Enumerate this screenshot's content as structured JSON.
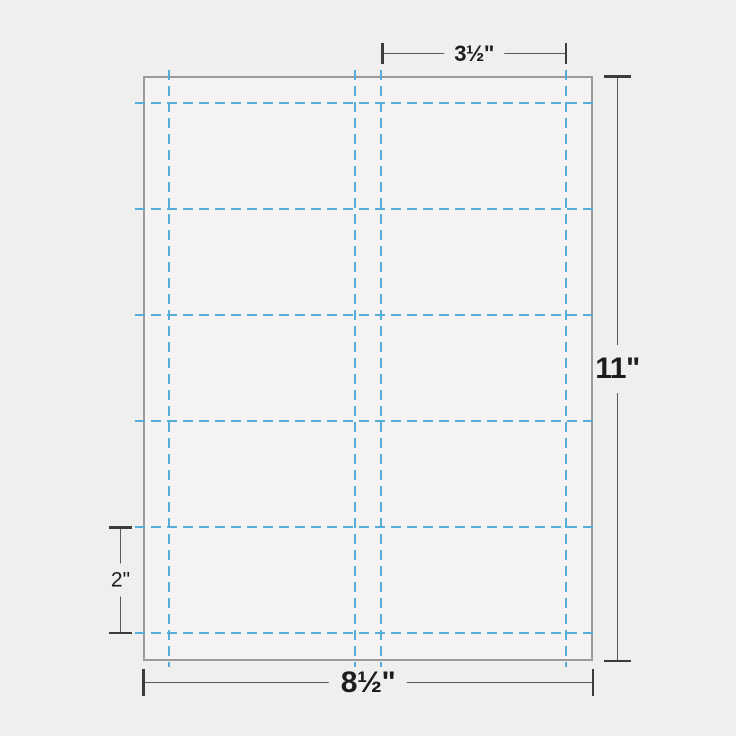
{
  "diagram": {
    "type": "print-layout-template",
    "subject": "business-card-sheet",
    "sheet": {
      "width_label": "8½\"",
      "height_label": "11\""
    },
    "card": {
      "width_label": "3½\"",
      "height_label": "2\""
    },
    "grid": {
      "columns": 2,
      "rows": 5,
      "vertical_cut_lines_x": [
        168,
        354,
        380,
        565
      ],
      "horizontal_cut_lines_y": [
        102,
        208,
        314,
        420,
        526,
        632
      ]
    },
    "colors": {
      "background": "#EFEFED",
      "sheet_fill": "#F3F3F1",
      "sheet_border": "#9B9B9B",
      "perforation_blue": "#58ACD8",
      "dimension_line": "#5A5A5A",
      "dimension_tick": "#3C3C3C",
      "label_text": "#1D1D1D"
    }
  }
}
